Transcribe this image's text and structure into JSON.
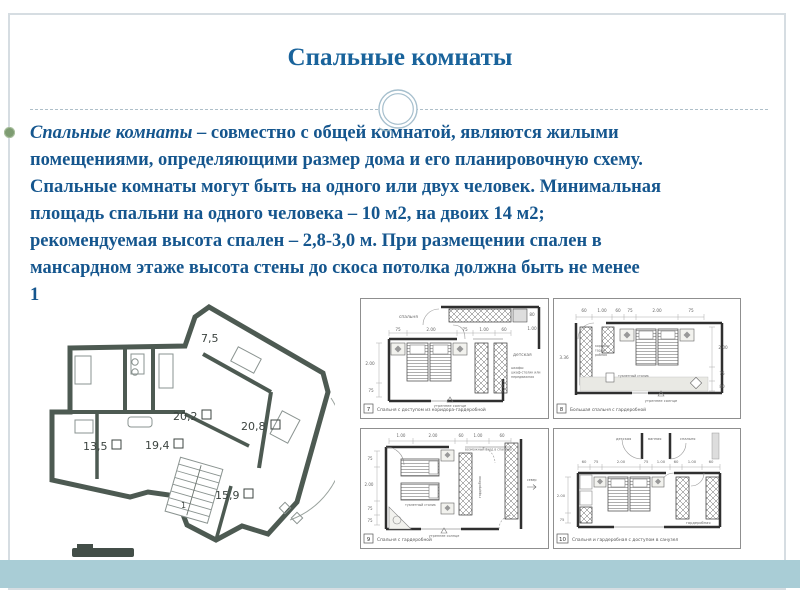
{
  "slide": {
    "title": "Спальные комнаты",
    "body": {
      "lead_italic": "Спальные комнаты",
      "line1_rest": " – совместно с общей комнатой, являются жилыми",
      "lines": [
        "помещениями, определяющими размер дома и его планировочную схему.",
        "Спальные комнаты могут быть на одного или двух человек. Минимальная",
        "площадь спальни на одного человека – 10 м2, на двоих 14 м2;",
        "рекомендуемая высота спален – 2,8-3,0 м. При размещении спален в",
        "мансардном этаже высота стены до скоса потолка должна быть не менее",
        "1"
      ]
    }
  },
  "colors": {
    "title": "#19639b",
    "body_text": "#15568e",
    "bottom_band": "#a9cdd6",
    "plan_walls": "#4d5a52",
    "bullet": "#7e9c72"
  },
  "floor_plan": {
    "areas": [
      "7,5",
      "20,2",
      "20,8",
      "13,5",
      "19,4",
      "15,9"
    ],
    "stair_label": "1"
  },
  "diagrams": [
    {
      "number": "7",
      "caption": "Спальня с доступом из коридора-гардеробной",
      "dims_top": [
        "75",
        "2.00",
        "75",
        "1.00",
        "60"
      ],
      "dims_left": [
        "2.00",
        "75"
      ],
      "dims_right": [
        "80",
        "1.00"
      ],
      "labels": {
        "room": "спальня",
        "room2": "детская",
        "note1": "шкафы:",
        "note2": "шкаф-столик или",
        "note3": "передвижная",
        "sun": "утреннее солнце"
      }
    },
    {
      "number": "8",
      "caption": "Большая спальня с гардеробной",
      "dims_top": [
        "60",
        "1.00",
        "60",
        "75",
        "2.00",
        "75"
      ],
      "dims_left": [
        "3.36"
      ],
      "dims_right": [
        "2.00",
        "75",
        "80"
      ],
      "labels": {
        "wardrobe1": "коридор-",
        "wardrobe2": "гарде-",
        "wardrobe3": "робная",
        "table": "туалетный столик",
        "sun": "утреннее солнце"
      }
    },
    {
      "number": "9",
      "caption": "Спальня с гардеробной",
      "dims_top": [
        "1.00",
        "2.00",
        "60",
        "1.00",
        "60"
      ],
      "dims_left": [
        "75",
        "2.00",
        "75",
        "75"
      ],
      "labels": {
        "entry": "возможный вход в спальню",
        "table": "туалетный столик",
        "wardrobe": "гардеробная",
        "north": "север",
        "sun": "утреннее солнце"
      }
    },
    {
      "number": "10",
      "caption": "Спальня и гардеробная  с доступом в санузел",
      "dims_top": [
        "60",
        "75",
        "2.00",
        "75",
        "1.00",
        "60",
        "1.00",
        "60"
      ],
      "dims_left": [
        "2.00",
        "75"
      ],
      "labels": {
        "room1": "детская",
        "room2": "ванная",
        "room3": "спальня",
        "wardrobe": "гардеробная"
      }
    }
  ]
}
